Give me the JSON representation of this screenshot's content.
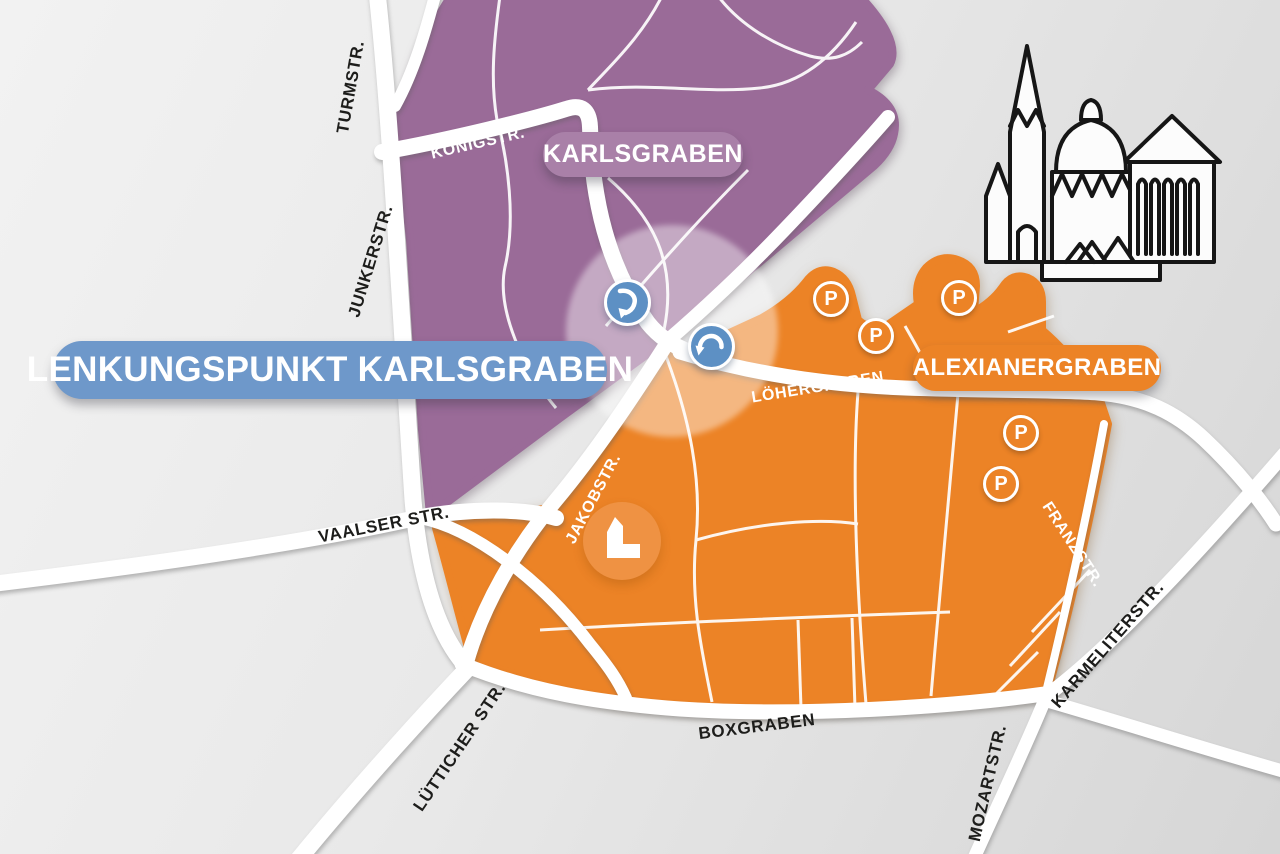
{
  "title": {
    "label": "LENKUNGSPUNKT KARLSGRABEN"
  },
  "zones": {
    "karlsgraben": {
      "label": "KARLSGRABEN",
      "color": "#9a6b98",
      "pill_bg": "#a980a8"
    },
    "alexianergraben": {
      "label": "ALEXIANERGRABEN",
      "color": "#ec8326",
      "pill_bg": "#ec8326"
    }
  },
  "streets": {
    "turmstr": "TURMSTR.",
    "junkerstr": "JUNKERSTR.",
    "koenigstr": "KÖNIGSTR.",
    "jakobstr_nord": "JAKOBSTR.",
    "jakobstr_sued": "JAKOBSTR.",
    "loehergraben": "LÖHERGRABEN",
    "vaalser_str": "VAALSER STR.",
    "luetticher_str": "LÜTTICHER STR.",
    "boxgraben": "BOXGRABEN",
    "mozartstr": "MOZARTSTR.",
    "karmeliterstr": "KARMELITERSTR.",
    "franzstr": "FRANZSTR."
  },
  "markers": {
    "parking_label": "P",
    "parking_count": 5
  },
  "icons": {
    "cathedral": "aachen-cathedral-icon",
    "church_building": "church-building-icon",
    "turn_right_down": "curved-arrow-right-down-icon",
    "turn_left_down": "curved-arrow-left-down-icon",
    "parking": "parking-icon"
  },
  "colors": {
    "zone_purple": "#9a6b98",
    "zone_purple_pill": "#a980a8",
    "zone_orange": "#ec8326",
    "title_blue": "#6e98ca",
    "marker_blue": "#5d90c4",
    "building_circle": "#ef9243",
    "road_white": "#ffffff",
    "street_label_dark": "#1d1d1b",
    "background_gray": "#e8e8e8"
  }
}
